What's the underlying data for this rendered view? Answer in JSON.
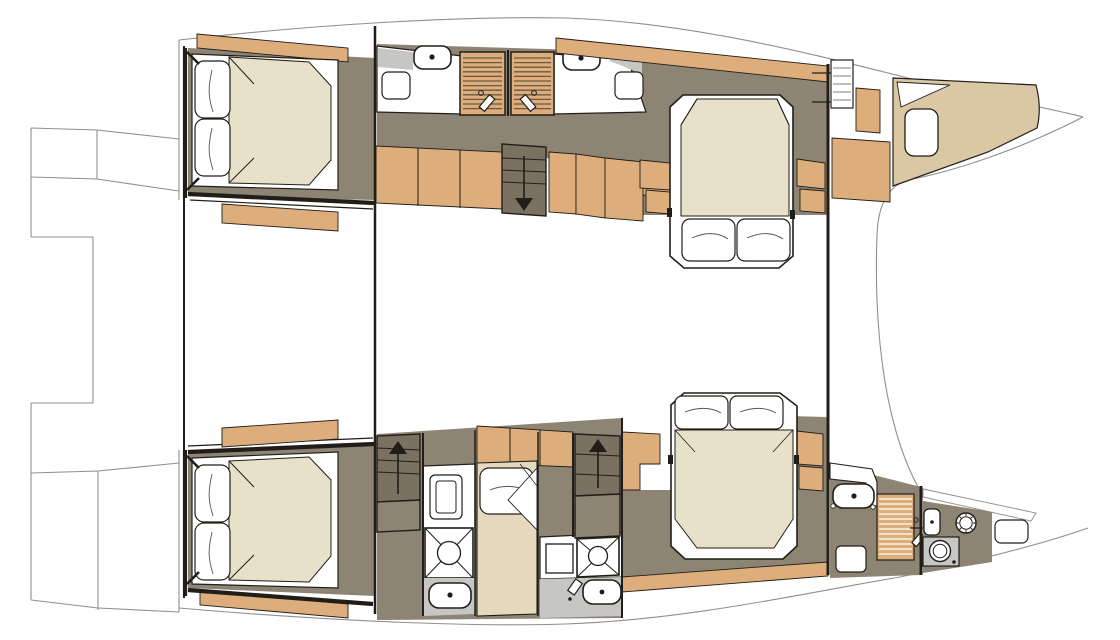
{
  "diagram": {
    "title": "Catamaran interior layout plan — lower deck, twin hulls with five cabins",
    "type": "floor-plan",
    "canvas": {
      "width": 1120,
      "height": 640
    },
    "colors": {
      "ink": "#211e19",
      "hullline": "#8f8f8f",
      "wood": "#ddae7c",
      "woodline": "#6a5940",
      "tan": "#d9c8a3",
      "mat": "#e8e1c9",
      "matpale": "#e4d9bc",
      "floor": "#8d8474",
      "floordark": "#7a7161",
      "graylight": "#c6c6c4",
      "grateline": "#f2e9d4",
      "white": "#ffffff"
    },
    "hull_top": {
      "aft_cabin": {
        "name": "aft double cabin",
        "fixtures": [
          "double-bed",
          "pillow",
          "pillow",
          "headboard-shelf",
          "wardrobe-panel"
        ]
      },
      "bathrooms": [
        {
          "name": "aft bathroom",
          "fixtures": [
            "toilet",
            "vanity-counter",
            "seat",
            "louvered-shower-door",
            "shower-mixer"
          ]
        },
        {
          "name": "forward bathroom",
          "fixtures": [
            "toilet",
            "vanity-counter",
            "seat",
            "louvered-shower-door",
            "shower-mixer"
          ]
        }
      ],
      "companionway": {
        "name": "companionway stairs",
        "direction": "down"
      },
      "lockers": {
        "name": "corridor storage lockers",
        "count": 7
      },
      "forward_cabin": {
        "name": "forward island-berth cabin",
        "fixtures": [
          "island-double-bed",
          "pillow",
          "pillow",
          "wardrobe",
          "wardrobe"
        ]
      },
      "bow": {
        "name": "bow storage / crew access",
        "fixtures": [
          "access-ladder",
          "storage-box",
          "storage-locker",
          "foredeck-platform",
          "deck-hatch"
        ]
      }
    },
    "hull_bottom": {
      "aft_cabin": {
        "name": "aft double cabin",
        "fixtures": [
          "double-bed",
          "pillow",
          "pillow",
          "wardrobe-panel"
        ]
      },
      "companionways": [
        {
          "name": "aft companionway stairs",
          "direction": "up"
        },
        {
          "name": "forward companionway stairs",
          "direction": "up"
        }
      ],
      "bathroom_aft": {
        "name": "aft bathroom",
        "fixtures": [
          "storage-cabinet",
          "shower-tray",
          "toilet"
        ]
      },
      "crew_berth": {
        "name": "single berth",
        "fixtures": [
          "single-mattress",
          "pillow",
          "overhead-lockers"
        ]
      },
      "bathroom_mid": {
        "name": "mid bathroom",
        "fixtures": [
          "washbasin-cabinet",
          "shower-tray",
          "toilet"
        ]
      },
      "forward_cabin": {
        "name": "forward island-berth cabin",
        "fixtures": [
          "island-double-bed",
          "pillow",
          "pillow",
          "wardrobe",
          "wardrobe"
        ]
      },
      "forward_head": {
        "name": "forward head / utility",
        "fixtures": [
          "vanity-counter",
          "toilet",
          "teak-shower-grate",
          "shower-mixer",
          "floor-hatch",
          "washbasin",
          "deck-porthole",
          "washing-machine",
          "bow-hatch"
        ]
      }
    },
    "deck": {
      "stern": [
        "transom-steps",
        "swim-platform",
        "transom-steps"
      ],
      "midship": [
        "bridgedeck",
        "cockpit-step-panel",
        "cockpit-step-panel"
      ],
      "bow": [
        "trampoline-gap",
        "foredeck"
      ]
    }
  }
}
